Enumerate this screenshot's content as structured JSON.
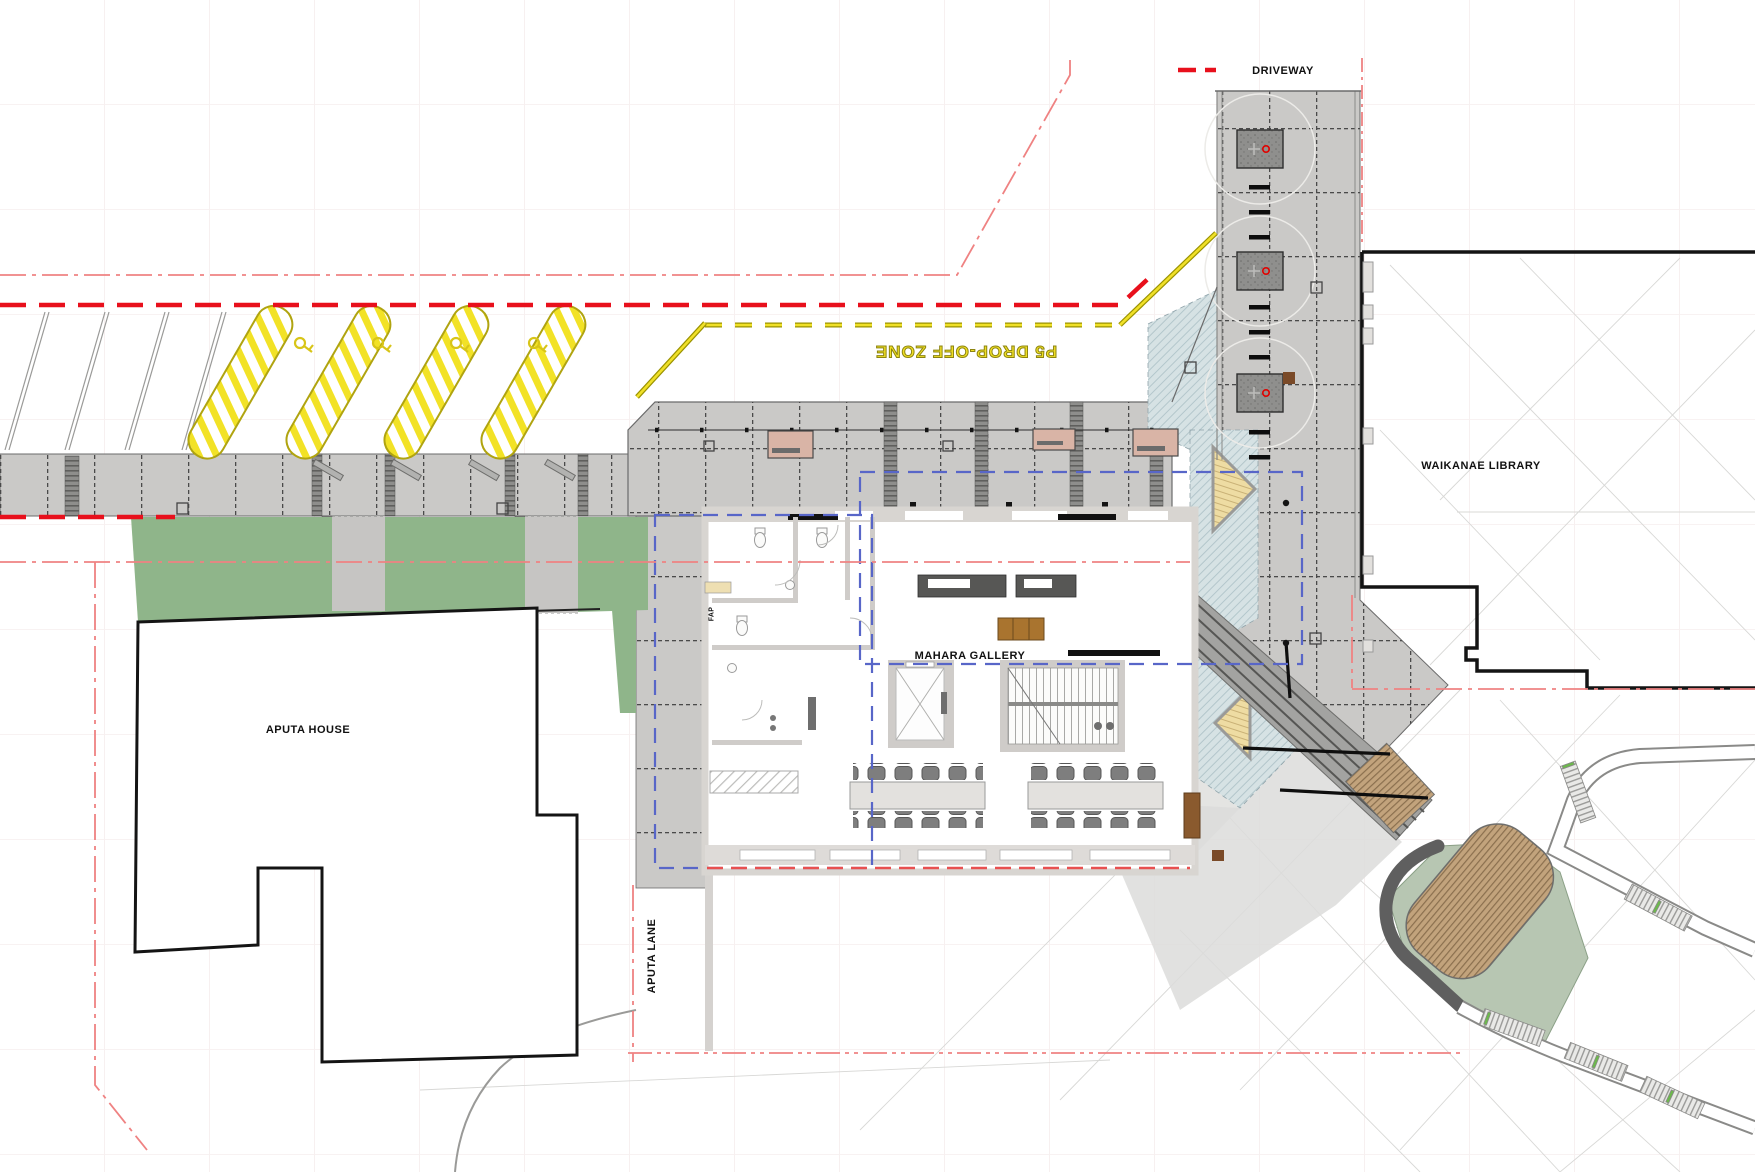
{
  "plan": {
    "title": "Mahara Gallery ground floor and site plan",
    "labels": {
      "driveway": "DRIVEWAY",
      "library": "WAIKANAE LIBRARY",
      "house": "APUTA HOUSE",
      "gallery": "MAHARA GALLERY",
      "lane": "APUTA LANE",
      "dropoff_zone": "P5 DROP-OFF ZONE",
      "fap": "FAP"
    },
    "colors": {
      "boundary_red_dashed": "#e8101c",
      "centerline_red_dashdot": "#ef8282",
      "road_marking_yellow": "#f0e028",
      "canopy_outline_blue": "#5866c8",
      "lawn_green": "#8fb58a",
      "lawn_light_green": "#b7c6b2",
      "paving_gray": "#cac9c7",
      "timber_deck_tan": "#c2a37c",
      "bench_pink": "#d9b4a6",
      "table_brown": "#a9742f",
      "tree_marker_red": "#e00200"
    },
    "features": {
      "accessible_parking_bars": 4,
      "parking_wheel_stops": 4,
      "driveway_tree_pits": 3,
      "driveway_speed_bars": 8,
      "plaza_benches": 4,
      "gallery_long_tables": 2,
      "elevator": "lift shaft with X symbol",
      "stairs": "internal stair with treads",
      "external_ramp": "diagonal stepped ramp with handrails",
      "timber_decks": 2
    }
  }
}
